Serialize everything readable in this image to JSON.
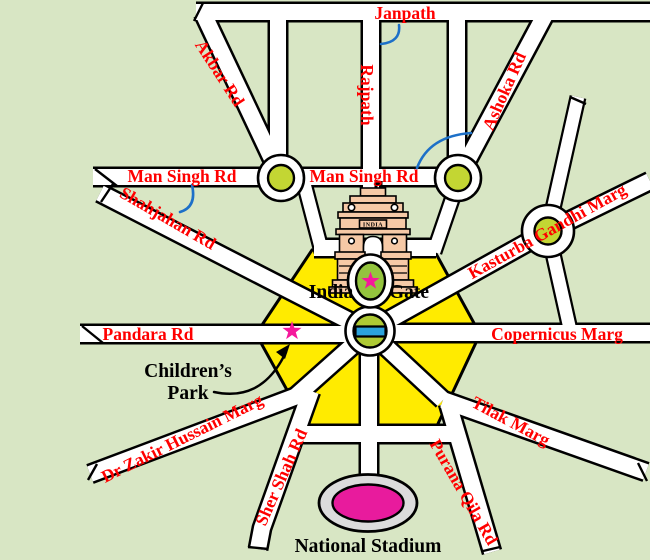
{
  "roads": {
    "janpath": "Janpath",
    "rajpath": "Rajpath",
    "akbar": "Akbar Rd",
    "ashoka": "Ashoka Rd",
    "man_singh_west": "Man Singh Rd",
    "man_singh_east": "Man Singh Rd",
    "shahjahan": "Shahjahan Rd",
    "kasturba": "Kasturba Gandhi Marg",
    "pandara": "Pandara Rd",
    "copernicus": "Copernicus Marg",
    "tilak": "Tilak Marg",
    "purana": "Purana Qila Rd",
    "dr_zakir": "Dr Zakir Hussain Marg",
    "sher_shah": "Sher Shah Rd"
  },
  "places": {
    "india_gate_left": "India",
    "india_gate_right": "Gate",
    "childrens_park_line1": "Children’s",
    "childrens_park_line2": "Park",
    "national_stadium": "National Stadium",
    "india_gate_inscription": "INDIA"
  },
  "colors": {
    "bg": "#d8e6c4",
    "hexagon": "#ffeb00",
    "roundabout_green": "#c3d633",
    "circle_green": "#aeca35",
    "ellipse_green": "#94c43e",
    "canopy_blue": "#2ba3dc",
    "star_pink": "#f5189c",
    "stadium_ring": "#dcdcdc",
    "stadium_pink": "#e81b9d",
    "monument": "#f6c9a6",
    "label_red": "#ff0000",
    "arc_blue": "#1d70c8"
  }
}
